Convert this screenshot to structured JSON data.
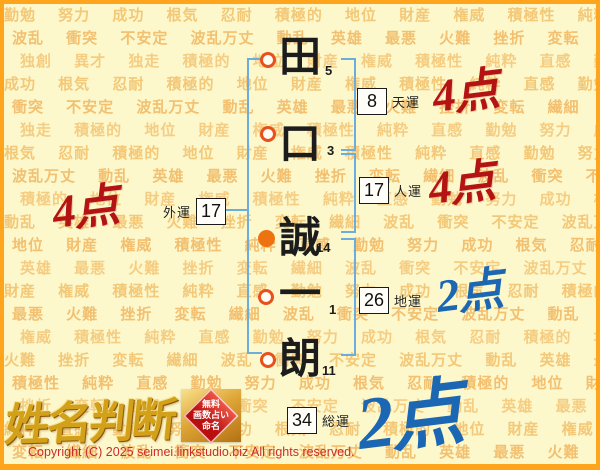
{
  "page": {
    "copyright": "Copyright (C) 2025 seimei.linkstudio.biz All rights reserved."
  },
  "logo": {
    "title": "姓名判断",
    "badge_lines": [
      "無料",
      "画数占い",
      "命名"
    ]
  },
  "name": {
    "chars": [
      {
        "char": "田",
        "strokes": "5",
        "mark": "open"
      },
      {
        "char": "口",
        "strokes": "3",
        "mark": "open"
      },
      {
        "char": "誠",
        "strokes": "14",
        "mark": "filled"
      },
      {
        "char": "一",
        "strokes": "1",
        "mark": "open"
      },
      {
        "char": "朗",
        "strokes": "11",
        "mark": "open"
      }
    ]
  },
  "fortunes": {
    "tenun": {
      "value": "8",
      "label": "天運",
      "score": "4点"
    },
    "jinun": {
      "value": "17",
      "label": "人運",
      "score": "4点"
    },
    "chiun": {
      "value": "26",
      "label": "地運",
      "score": "2点"
    },
    "soun": {
      "value": "34",
      "label": "総運",
      "score": "2点"
    },
    "gaiun": {
      "value": "17",
      "label": "外運",
      "score": "4点"
    }
  },
  "colors": {
    "score_red": "#b31312",
    "score_blue": "#1b67b4",
    "bracket_blue": "#6cadde",
    "border_orange": "#ffa41d",
    "background": "#fdf8cc",
    "watermark_text": "#f3c878",
    "circle_orange": "#e8511d",
    "badge_red": "#b80f0f",
    "logo_gold": "#d2a019"
  },
  "watermark": {
    "rows": [
      "勤勉 努力 成功 根気 忍耐 積極的 地位 財産 権威 積極性 純粋 直感 勤勉 努力",
      "波乱 衝突 不安定 波乱万丈 動乱 英雄 最悪 火難 挫折 変転 繊細 波乱 衝突",
      "独創 異才 独走 積極的 地位 財産 権威 積極性 純粋 直感 勤勉 努力 成功",
      "成功 根気 忍耐 積極的 地位 財産 権威 積極性 純粋 直感 勤勉 努力 成功",
      "衝突 不安定 波乱万丈 動乱 英雄 最悪 火難 挫折 変転 繊細 波乱 衝突",
      "独走 積極的 地位 財産 権威 積極性 純粋 直感 勤勉 努力 成功 根気",
      "根気 忍耐 積極的 地位 財産 権威 積極性 純粋 直感 勤勉 努力 成功",
      "波乱万丈 動乱 英雄 最悪 火難 挫折 変転 繊細 波乱 衝突 不安定",
      "積極的 地位 財産 権威 積極性 純粋 直感 勤勉 努力 成功 根気 忍耐",
      "動乱 英雄 最悪 火難 挫折 変転 繊細 波乱 衝突 不安定 波乱万丈",
      "地位 財産 権威 積極性 純粋 直感 勤勉 努力 成功 根気 忍耐 積極的",
      "英雄 最悪 火難 挫折 変転 繊細 波乱 衝突 不安定 波乱万丈 動乱",
      "財産 権威 積極性 純粋 直感 勤勉 努力 成功 根気 忍耐 積極的 地位",
      "最悪 火難 挫折 変転 繊細 波乱 衝突 不安定 波乱万丈 動乱 英雄",
      "権威 積極性 純粋 直感 勤勉 努力 成功 根気 忍耐 積極的 地位 財産",
      "火難 挫折 変転 繊細 波乱 衝突 不安定 波乱万丈 動乱 英雄 最悪",
      "積極性 純粋 直感 勤勉 努力 成功 根気 忍耐 積極的 地位 財産 権威",
      "挫折 変転 繊細 波乱 衝突 不安定 波乱万丈 動乱 英雄 最悪 火難",
      "純粋 直感 勤勉 努力 成功 根気 忍耐 積極的 地位 財産 権威 積極性",
      "変転 繊細 波乱 衝突 不安定 波乱万丈 動乱 英雄 最悪 火難 挫折"
    ]
  }
}
